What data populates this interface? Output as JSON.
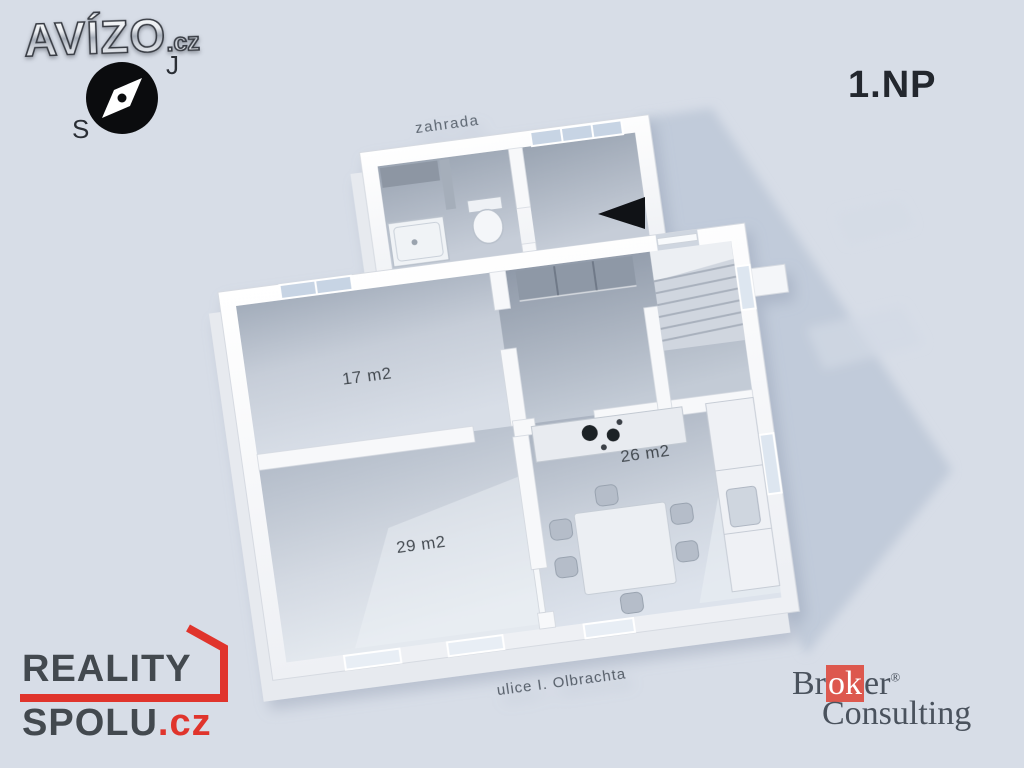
{
  "scene": {
    "floor_label": "1.NP",
    "garden_label": "zahrada",
    "street_label": "ulice I. Olbrachta",
    "rooms": [
      {
        "id": "room-17",
        "area_label": "17 m2"
      },
      {
        "id": "room-29",
        "area_label": "29 m2"
      },
      {
        "id": "kitchen-26",
        "area_label": "26 m2"
      }
    ],
    "colors": {
      "background": "#d7dde7",
      "cast_shadow": "#bfc9d8",
      "walls": "#ffffff",
      "floor_dark": "#97a1af",
      "floor_light": "#e2e7ee",
      "label_text": "#40464e",
      "entrance_arrow": "#101216"
    },
    "icons": {
      "entrance_arrow": "triangle-left"
    }
  },
  "branding": {
    "avizo": {
      "name": "AVÍZO",
      "tld": ".cz"
    },
    "compass": {
      "s_label": "S",
      "j_label": "J",
      "icon": "compass-rose"
    },
    "reality_spolu": {
      "line1": "REALITY",
      "line2": "SPOLU",
      "tld": ".cz",
      "accent_color": "#e0342c"
    },
    "broker_consulting": {
      "line1_prefix": "Br",
      "line1_highlight": "ok",
      "line1_suffix": "er",
      "registered_mark": "®",
      "line2": "Consulting",
      "highlight_color": "#dd584e"
    }
  }
}
